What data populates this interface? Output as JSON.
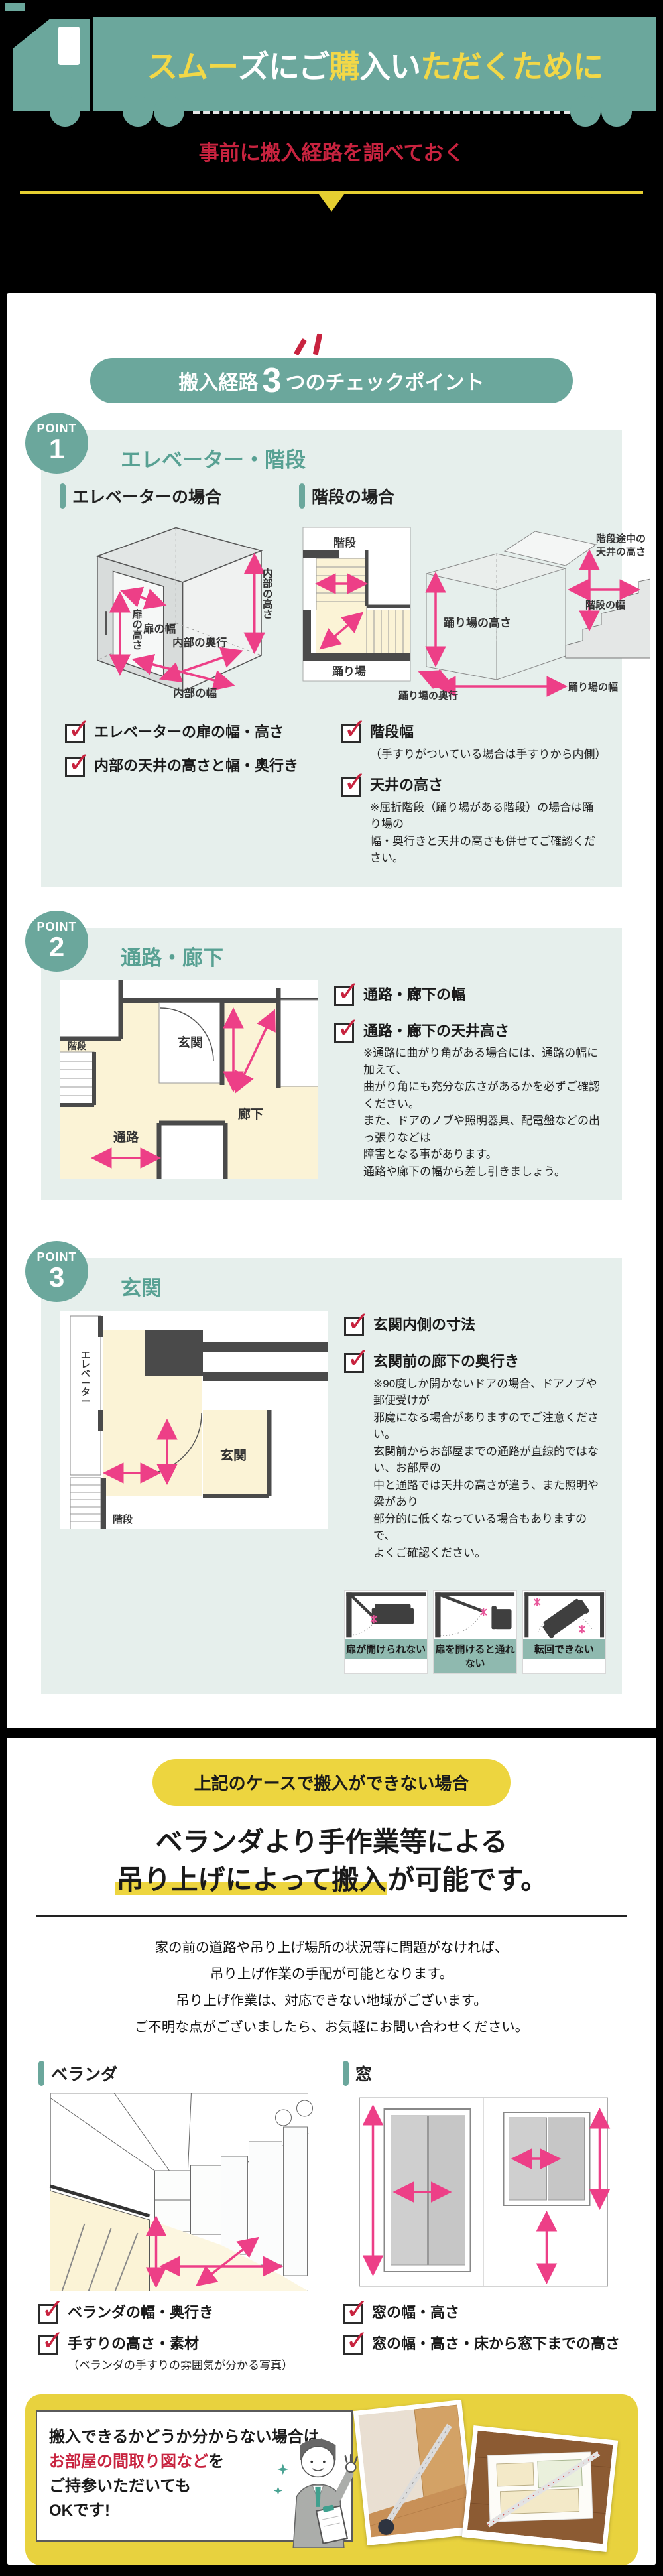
{
  "colors": {
    "teal": "#6BA79C",
    "panel": "#E6EFEC",
    "yellow": "#EDD53F",
    "red": "#C8233F",
    "pink": "#ED3F87"
  },
  "header": {
    "title_segments": [
      {
        "text": "スムー",
        "color": "#F2D847"
      },
      {
        "text": "ズにご",
        "color": "#FFFFFF"
      },
      {
        "text": "購",
        "color": "#F2D847"
      },
      {
        "text": "入い",
        "color": "#FFFFFF"
      },
      {
        "text": "ただくために",
        "color": "#F2D847"
      }
    ],
    "subtitle": "事前に搬入経路を調べておく"
  },
  "checkpoint": {
    "pre": "搬入経路",
    "num": "3",
    "post": "つのチェックポイント"
  },
  "point_label": "POINT",
  "point1": {
    "num": "1",
    "title": "エレベーター・階段",
    "elevator": {
      "heading": "エレベーターの場合",
      "labels": {
        "door_width": "扉の幅",
        "door_height": "扉の高さ",
        "inner_height": "内部の高さ",
        "inner_depth": "内部の奥行",
        "inner_width": "内部の幅"
      }
    },
    "stairs": {
      "heading": "階段の場合",
      "labels": {
        "stairs": "階段",
        "landing": "踊り場",
        "landing_height": "踊り場の高さ",
        "mid_ceiling_1": "階段途中の",
        "mid_ceiling_2": "天井の高さ",
        "stair_width": "階段の幅",
        "landing_width": "踊り場の幅",
        "landing_depth": "踊り場の奥行"
      }
    },
    "checks_left": [
      {
        "label": "エレベーターの扉の幅・高さ"
      },
      {
        "label": "内部の天井の高さと幅・奥行き"
      }
    ],
    "checks_right": [
      {
        "label": "階段幅",
        "note": "（手すりがついている場合は手すりから内側）"
      },
      {
        "label": "天井の高さ",
        "note": "※屈折階段（踊り場がある階段）の場合は踊り場の\n幅・奥行きと天井の高さも併せてご確認ください。"
      }
    ]
  },
  "point2": {
    "num": "2",
    "title": "通路・廊下",
    "plan": {
      "genkan": "玄関",
      "rouka": "廊下",
      "kaidan": "階段",
      "tsuro": "通路"
    },
    "checks": [
      {
        "label": "通路・廊下の幅"
      },
      {
        "label": "通路・廊下の天井高さ",
        "note": "※通路に曲がり角がある場合には、通路の幅に加えて、\n曲がり角にも充分な広さがあるかを必ずご確認ください。\nまた、ドアのノブや照明器具、配電盤などの出っ張りなどは\n障害となる事があります。\n通路や廊下の幅から差し引きましょう。"
      }
    ]
  },
  "point3": {
    "num": "3",
    "title": "玄関",
    "plan": {
      "elevator": "エレベーター",
      "genkan": "玄関",
      "kaidan": "階段"
    },
    "checks": [
      {
        "label": "玄関内側の寸法"
      },
      {
        "label": "玄関前の廊下の奥行き",
        "note": "※90度しか開かないドアの場合、ドアノブや郵便受けが\n邪魔になる場合がありますのでご注意ください。\n玄関前からお部屋までの通路が直線的ではない、お部屋の\n中と通路では天井の高さが違う、また照明や梁があり\n部分的に低くなっている場合もありますので、\nよくご確認ください。"
      }
    ],
    "thumbs": [
      {
        "caption": "扉が開けられない"
      },
      {
        "caption": "扉を開けると通れない"
      },
      {
        "caption": "転回できない"
      }
    ]
  },
  "lift": {
    "badge": "上記のケースで搬入ができない場合",
    "title1": "ベランダより手作業等による",
    "title2_hl": "吊り上げによって搬入",
    "title2_rest": "が可能です。",
    "p1": "家の前の道路や吊り上げ場所の状況等に問題がなければ、",
    "p2": "吊り上げ作業の手配が可能となります。",
    "p3": "吊り上げ作業は、対応できない地域がございます。",
    "p4": "ご不明な点がございましたら、お気軽にお問い合わせください。",
    "veranda": {
      "heading": "ベランダ",
      "checks": [
        {
          "label": "ベランダの幅・奥行き"
        },
        {
          "label": "手すりの高さ・素材",
          "note": "（ベランダの手すりの雰囲気が分かる写真）"
        }
      ]
    },
    "window": {
      "heading": "窓",
      "checks": [
        {
          "label": "窓の幅・高さ"
        },
        {
          "label": "窓の幅・高さ・床から窓下までの高さ"
        }
      ]
    }
  },
  "ok": {
    "line1": "搬入できるかどうか分からない場合は、",
    "line2_red": "お部屋の間取り図など",
    "line2_black": "を",
    "line3": "ご持参いただいても",
    "line4": "OKです!"
  }
}
